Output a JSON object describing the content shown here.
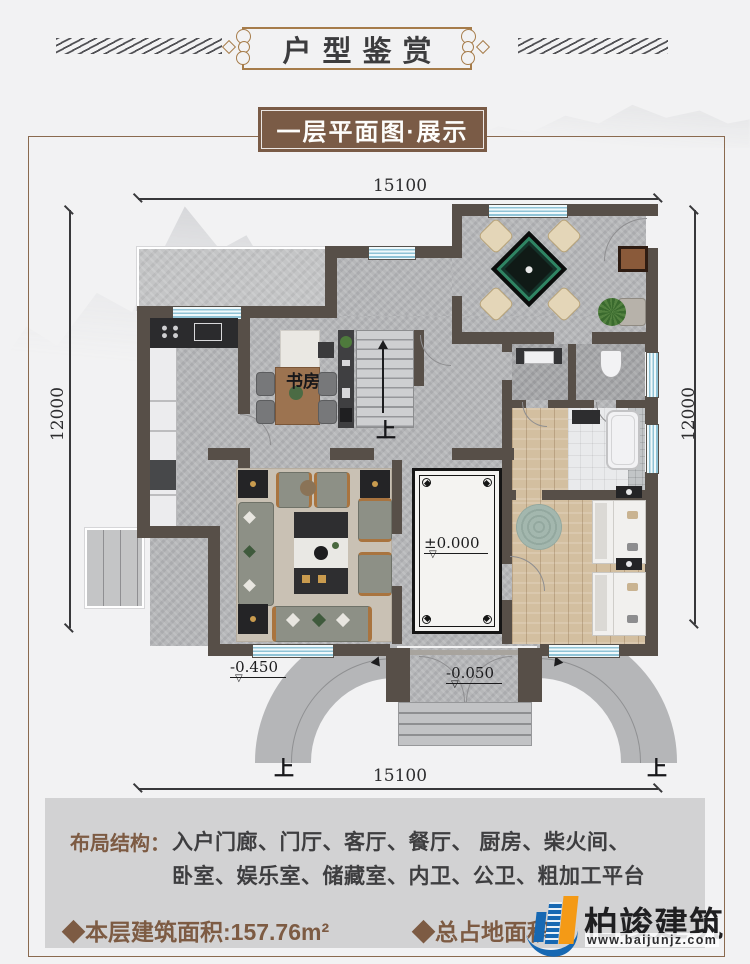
{
  "header": {
    "title": "户型鉴赏",
    "subtitle": "一层平面图·展示"
  },
  "plan": {
    "dimensions": {
      "top": "15100",
      "bottom": "15100",
      "left": "12000",
      "right": "12000"
    },
    "labels": {
      "study": "书房",
      "stairs_up": "上",
      "ramp_left_up": "上",
      "ramp_right_up": "上"
    },
    "levels": {
      "foyer": "±0.000",
      "porch": "-0.050",
      "ramp": "-0.450",
      "marker": "▽"
    }
  },
  "footer": {
    "layout_label": "布局结构：",
    "layout_line1": "入户门廊、门厅、客厅、餐厅、 厨房、柴火间、",
    "layout_line2": "卧室、娱乐室、储藏室、内卫、公卫、粗加工平台",
    "area_floor": "◆本层建筑面积:157.76m²",
    "area_total": "◆总占地面积",
    "brand": {
      "name": "柏竣建筑",
      "url": "www.baijunjz.com"
    }
  },
  "colors": {
    "accent": "#a67c4a",
    "subtitle_bg": "#7a5b46",
    "panel_bg": "#d2d2d3",
    "text_brown": "#7d5b43",
    "wall": "#574f48",
    "brand_blue": "#1668b3",
    "brand_orange": "#f49a16"
  }
}
